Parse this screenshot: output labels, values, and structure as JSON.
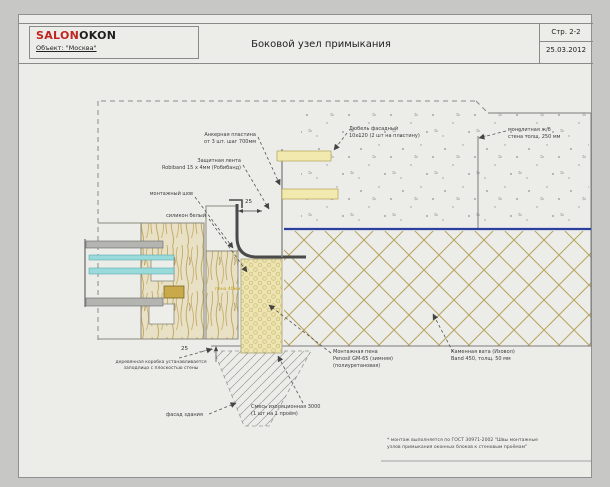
{
  "header": {
    "logo_primary": "SALON",
    "logo_secondary": "OKON",
    "object_line": "Объект: \"Москва\"",
    "title": "Боковой узел примыкания",
    "page_label": "Стр. 2-2",
    "date": "25.03.2012"
  },
  "drawing": {
    "callouts": [
      {
        "lines": [
          "Анкерная пластина",
          "от 3 шт. шаг 700мм"
        ]
      },
      {
        "lines": [
          "Защитная лента",
          "Robiband 15 х 4мм (Робибанд)"
        ]
      },
      {
        "lines": [
          "монтажный шов"
        ]
      },
      {
        "lines": [
          "силикон белый"
        ]
      },
      {
        "lines": [
          "Дюбель фасадный",
          "10х120 (2 шт на пластину)"
        ]
      },
      {
        "lines": [
          "монолитная ж/б",
          "стена толщ. 250 мм"
        ]
      },
      {
        "lines": [
          "Монтажная пена",
          "Penosil GM-65 (зимняя)",
          "(полиуретановая)"
        ]
      },
      {
        "lines": [
          "Каменная вата (Изовол)",
          "Band 450, толщ. 50 мм"
        ]
      },
      {
        "lines": [
          "деревянная коробка устанавливается",
          "заподлицо с плоскостью стены"
        ]
      },
      {
        "lines": [
          "фасад здания"
        ]
      },
      {
        "lines": [
          "Смесь изоляционная 3000",
          "(1 шт на 1 проём)"
        ]
      }
    ],
    "dimensions": {
      "top": "25",
      "bottom": "25"
    },
    "inline_label": "пена 40мм",
    "footnote": {
      "line1": "* монтаж выполняется по ГОСТ 30971-2002 \"Швы монтажные",
      "line2": "узлов примыкания оконных блоков к стеновым проёмам\""
    },
    "colors": {
      "logo_red": "#c0251f",
      "membrane_blue": "#2b3f9e",
      "foam_yellow": "#ece4b2",
      "glazing_cyan": "#9adada",
      "masonry_hatch": "#b7a55c"
    }
  }
}
